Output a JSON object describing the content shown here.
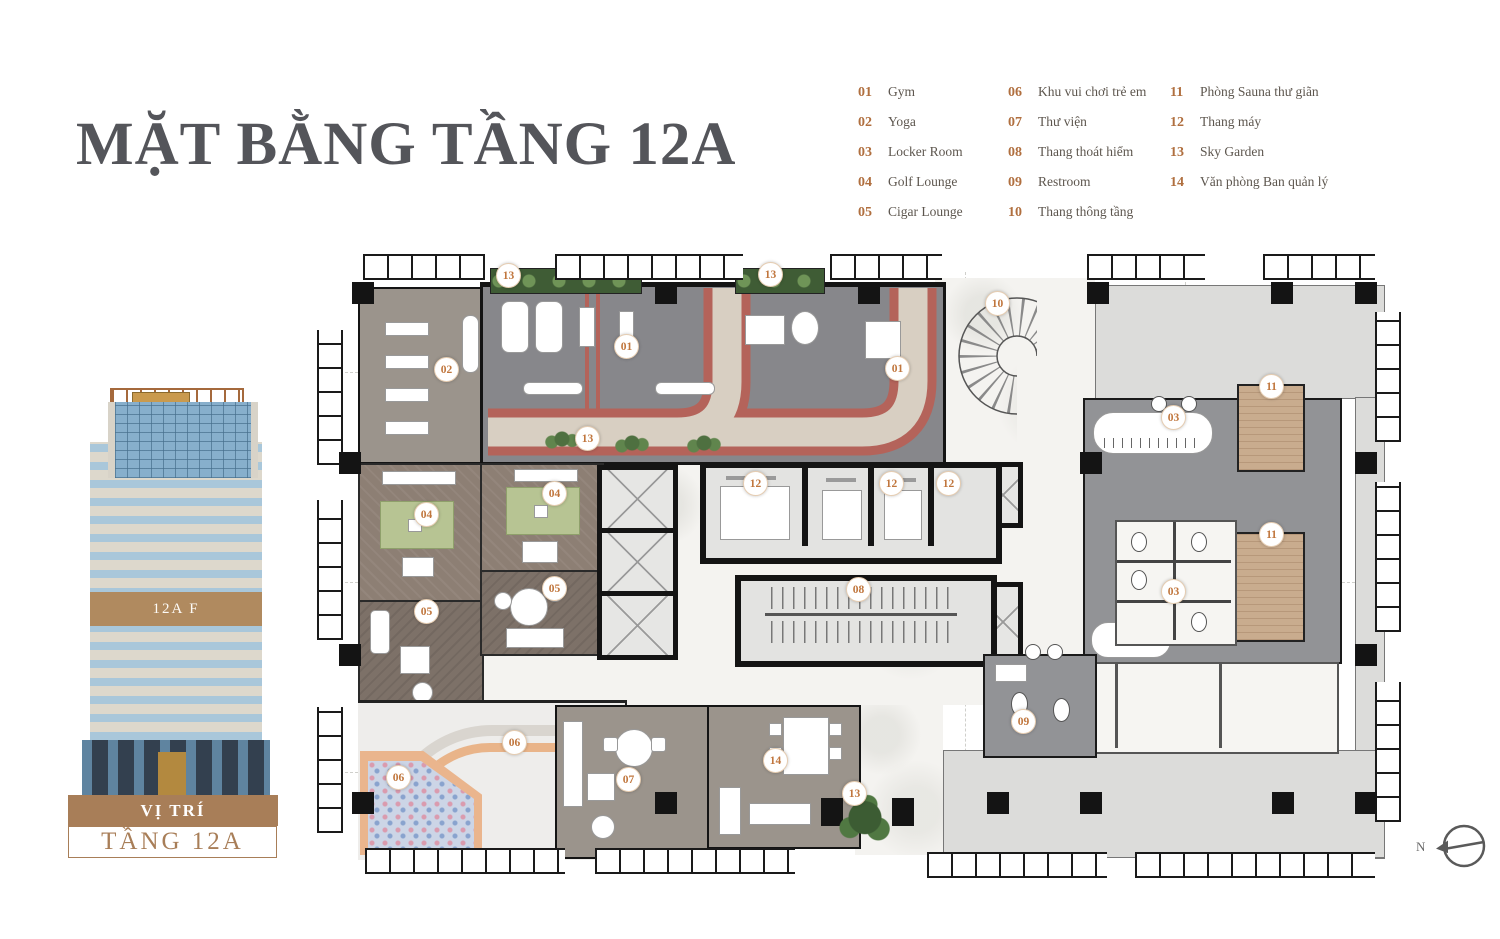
{
  "title": "MẶT BẰNG TẦNG 12A",
  "location": {
    "heading": "VỊ TRÍ",
    "floor": "TẦNG 12A"
  },
  "building": {
    "band_label": "12A F"
  },
  "compass": {
    "label": "N"
  },
  "palette": {
    "accent_orange": "#b06f3f",
    "brand_brown": "#a87e58",
    "title_gray": "#54555a",
    "track_red": "#b4635a",
    "track_beige": "#d8cfc2",
    "gym_gray": "#87878b",
    "terrace_gray": "#dcdcda",
    "sauna_tan": "#c9ac8e",
    "wall_black": "#141414",
    "floor_taupe": "#9b948c",
    "mat_green": "#b7c493",
    "ballpit_blue": "#ccd5e6"
  },
  "legend": {
    "col1": [
      {
        "num": "01",
        "label": "Gym"
      },
      {
        "num": "02",
        "label": "Yoga"
      },
      {
        "num": "03",
        "label": "Locker Room"
      },
      {
        "num": "04",
        "label": "Golf Lounge"
      },
      {
        "num": "05",
        "label": "Cigar Lounge"
      }
    ],
    "col2": [
      {
        "num": "06",
        "label": "Khu vui chơi trẻ em"
      },
      {
        "num": "07",
        "label": "Thư viện"
      },
      {
        "num": "08",
        "label": "Thang thoát hiểm"
      },
      {
        "num": "09",
        "label": "Restroom"
      },
      {
        "num": "10",
        "label": "Thang thông tầng"
      }
    ],
    "col3": [
      {
        "num": "11",
        "label": "Phòng Sauna thư giãn"
      },
      {
        "num": "12",
        "label": "Thang máy"
      },
      {
        "num": "13",
        "label": "Sky Garden"
      },
      {
        "num": "14",
        "label": "Văn phòng Ban quản lý"
      }
    ]
  },
  "plan": {
    "rooms": [
      "gym",
      "yoga",
      "locker-room",
      "golf-lounge",
      "cigar-lounge",
      "kids-play-area",
      "library",
      "escape-stair",
      "restroom",
      "open-stair",
      "sauna",
      "elevators",
      "sky-garden",
      "management-office"
    ],
    "badges": [
      {
        "n": "13",
        "x": 508,
        "y": 275
      },
      {
        "n": "13",
        "x": 770,
        "y": 274
      },
      {
        "n": "02",
        "x": 446,
        "y": 369
      },
      {
        "n": "01",
        "x": 626,
        "y": 346
      },
      {
        "n": "01",
        "x": 897,
        "y": 368
      },
      {
        "n": "10",
        "x": 997,
        "y": 303
      },
      {
        "n": "13",
        "x": 587,
        "y": 438
      },
      {
        "n": "11",
        "x": 1271,
        "y": 386
      },
      {
        "n": "03",
        "x": 1173,
        "y": 417
      },
      {
        "n": "04",
        "x": 426,
        "y": 514
      },
      {
        "n": "04",
        "x": 554,
        "y": 493
      },
      {
        "n": "05",
        "x": 554,
        "y": 588
      },
      {
        "n": "05",
        "x": 426,
        "y": 611
      },
      {
        "n": "12",
        "x": 755,
        "y": 483
      },
      {
        "n": "12",
        "x": 891,
        "y": 483
      },
      {
        "n": "12",
        "x": 948,
        "y": 483
      },
      {
        "n": "08",
        "x": 858,
        "y": 589
      },
      {
        "n": "11",
        "x": 1271,
        "y": 534
      },
      {
        "n": "03",
        "x": 1173,
        "y": 591
      },
      {
        "n": "06",
        "x": 514,
        "y": 742
      },
      {
        "n": "06",
        "x": 398,
        "y": 777
      },
      {
        "n": "07",
        "x": 628,
        "y": 779
      },
      {
        "n": "14",
        "x": 775,
        "y": 760
      },
      {
        "n": "13",
        "x": 854,
        "y": 793
      },
      {
        "n": "09",
        "x": 1023,
        "y": 721
      }
    ]
  }
}
